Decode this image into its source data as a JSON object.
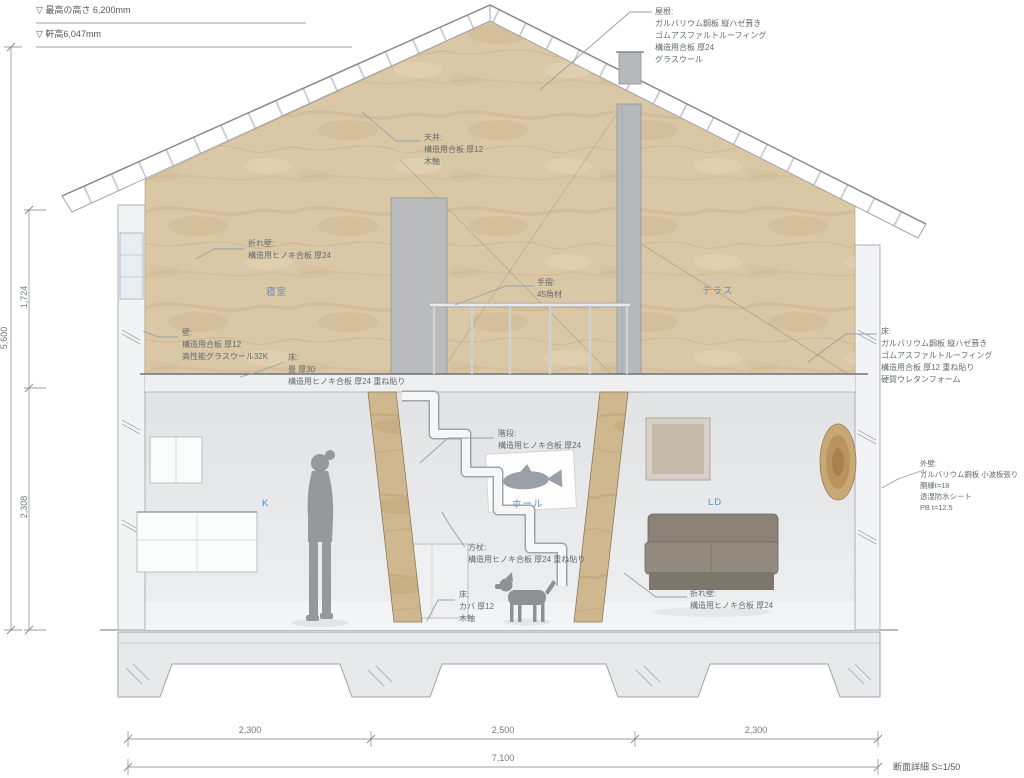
{
  "drawing": {
    "title": "断面詳細 S=1/50"
  },
  "levels": {
    "max_height": "▽ 最高の高さ 6,200mm",
    "eave_height": "▽ 軒高6,047mm"
  },
  "dimensions": {
    "height_total": "5,600",
    "height_upper": "1,724",
    "height_lower": "2,308",
    "span_left": "2,300",
    "span_center": "2,500",
    "span_right": "2,300",
    "span_total": "7,100"
  },
  "rooms": {
    "bedroom": "寝室",
    "terrace": "テラス",
    "kitchen": "K",
    "hall": "ホール",
    "living_dining": "LD"
  },
  "notes": {
    "roof": "屋根:\nガルバリウム鋼板 縦ハゼ葺き\nゴムアスファルトルーフィング\n構造用合板 厚24\nグラスウール",
    "ceiling": "天井:\n構造用合板 厚12\n木軸",
    "fold_wall_upper": "折れ壁:\n構造用ヒノキ合板 厚24",
    "handrail": "手摺:\n45角材",
    "terrace_floor": "床:\nガルバリウム鋼板 縦ハゼ葺き\nゴムアスファルトルーフィング\n構造用合板 厚12 重ね貼り\n硬質ウレタンフォーム",
    "wall": "壁:\n構造用合板 厚12\n高性能グラスウール32K",
    "tatami_floor": "床:\n畳 厚30\n構造用ヒノキ合板 厚24 重ね貼り",
    "stairs": "階段:\n構造用ヒノキ合板 厚24",
    "outer_wall": "外壁:\nガルバリウム鋼板 小波板張り\n胴縁t=18\n透湿防水シート\nPB t=12.5",
    "brace": "方杖:\n構造用ヒノキ合板 厚24 重ね貼り",
    "floor_kaba": "床:\nカバ 厚12\n木軸",
    "fold_wall_lower": "折れ壁:\n構造用ヒノキ合板 厚24"
  },
  "colors": {
    "plywood": "#dac7a6",
    "room_label": "#5f8cc4",
    "line": "#9aa0a5"
  }
}
